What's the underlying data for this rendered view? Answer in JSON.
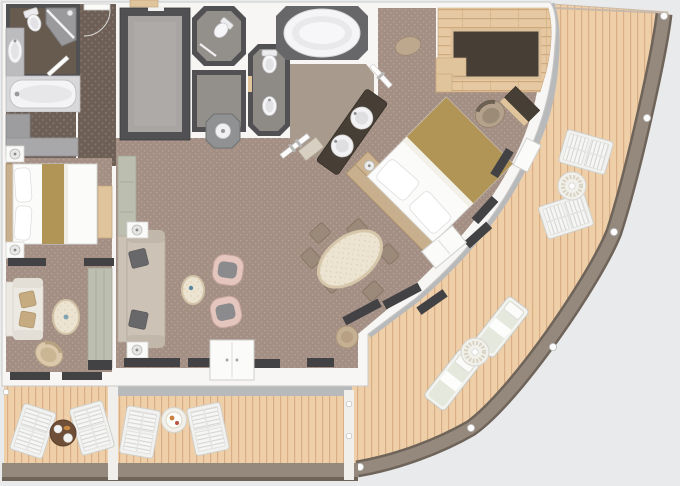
{
  "meta": {
    "figure": "ship-suite-floor-plan",
    "description_name": "two-bedroom-suite-with-wraparound-balcony"
  },
  "palette": {
    "background": "#e9eaec",
    "wall": "#f7f6f4",
    "wall_stroke": "#c9c9c7",
    "dark_wall": "#515153",
    "carpet": "#a48f85",
    "carpet_dot": "#b6a298",
    "corridor": "#6d5f56",
    "corridor_dot": "#83756a",
    "deck": "#efcfa8",
    "deck_line": "#d9ad85",
    "railing": "#95887d",
    "railing_dark": "#6f6459",
    "gray_strip": "#b7b9bb",
    "stone_floor": "#a8a5a2",
    "bath_gray": "#938f8b",
    "wc_floor": "#8e8a86",
    "bath_taupe": "#a89a8c",
    "tub_surround": "#67676a",
    "fixture_white": "#f4f4f6",
    "wood_floor": "#e6c9a2",
    "wood_line": "#cda97e",
    "desk_dark": "#473f36",
    "wood_trim": "#e0c49c",
    "bed_gold": "#b09556",
    "bed_wood": "#c8af8d",
    "sofa": "#cdc2b6",
    "pillow_dark": "#68686a",
    "armchair": "#e4c6be",
    "cushion_gray": "#8b8b8d",
    "cream": "#ece4d1",
    "cream_edge": "#d6c7ab",
    "dining_chair": "#9b8979",
    "cabinet_sage": "#bcbeb0",
    "window_dark": "#424244",
    "cream_sofa": "#ece9e2",
    "pillow_tan": "#c6ab80",
    "table_brown": "#6f4f38",
    "outdoor_white": "#f4f4f2",
    "lounger_cushion": "#e5e8dd",
    "pouf": "#bda78d"
  },
  "rooms": [
    "entry-corridor",
    "walk-in-closet",
    "guest-shower-room",
    "powder-room",
    "guest-bathroom",
    "guest-bedroom",
    "guest-sitting-area",
    "master-wc",
    "master-bathroom",
    "master-bedroom",
    "study-desk-area",
    "living-room",
    "dining-area",
    "balcony-left",
    "balcony-center",
    "balcony-wraparound"
  ],
  "furniture": {
    "guest_bathroom": [
      "bathtub",
      "toilet",
      "shower",
      "oval-sink"
    ],
    "master_bathroom": [
      "oval-bathtub",
      "double-round-sinks",
      "toilet",
      "bidet",
      "glass-doors"
    ],
    "master_bedroom": [
      "king-bed",
      "nightstands",
      "bench-vanity",
      "desk",
      "desk-chair",
      "ottoman"
    ],
    "living_room": [
      "sofa",
      "side-tables",
      "armchair",
      "armchair",
      "coffee-table",
      "media-cabinet"
    ],
    "dining_area": [
      "oval-dining-table",
      "dining-chairs-x6",
      "round-ottoman"
    ],
    "guest_suite": [
      "bed",
      "nightstands",
      "loveseat",
      "coffee-table",
      "swivel-chair",
      "wardrobe"
    ],
    "balconies": [
      "slatted-chairs",
      "round-tables",
      "sun-loungers",
      "railing-stanchions"
    ]
  }
}
